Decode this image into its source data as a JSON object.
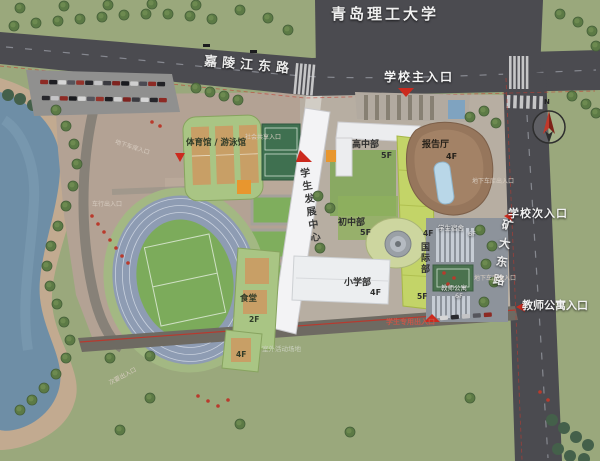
{
  "page": {
    "type": "campus-master-plan-rendering"
  },
  "labels": {
    "university": "青岛理工大学",
    "road_top": "嘉陵江东路",
    "road_right": "矿大东路",
    "main_entrance": "学校主入口",
    "secondary_entrance": "学校次入口",
    "teacher_entrance": "教师公寓入口",
    "gym": "体育馆 / 游泳馆",
    "student_center": "学生发展中心",
    "high_school": "高中部",
    "auditorium": "报告厅",
    "middle_school": "初中部",
    "international": "国际部",
    "primary_school": "小学部",
    "canteen": "食堂",
    "dorm": "学生宿舍",
    "teacher_apartment": "教师公寓",
    "compass_n": "N"
  },
  "floors": {
    "high_school": "5F",
    "auditorium": "4F",
    "middle_school": "5F",
    "international_top": "4F",
    "international_bottom": "5F",
    "primary_school": "4F",
    "canteen": "2F",
    "canteen_annex": "4F",
    "dorm": "6F",
    "teacher_apartment": "6F"
  },
  "mini_labels": {
    "garage_entrance_west": "地下车库入口",
    "shared_entrance": "社会共享入口",
    "west_vehicle_entrance": "车行出入口",
    "student_entrance": "学生专用出入口",
    "garage_entrance_east": "地下车库出入口",
    "southwest_entrance": "次要出入口",
    "outdoor_field": "室外活动场地"
  },
  "colors": {
    "grass": "#9aa87c",
    "road": "#4b4b50",
    "plaza": "#b3a294",
    "lake": "#6e8ea6",
    "beach": "#c2aa90",
    "track": "#8e9cb3",
    "sports_field": "#7cab5b",
    "building_green_roof": "#a9c584",
    "building_yellow": "#c3d468",
    "building_white": "#f3f3f5",
    "auditorium_brown": "#96765c",
    "boundary_red": "#c23b2f",
    "accent_orange": "#e8962e"
  }
}
